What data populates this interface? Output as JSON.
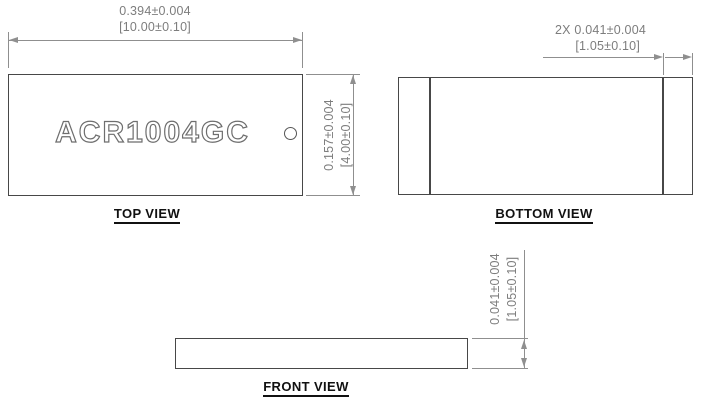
{
  "part_marking": "ACR1004GC",
  "views": {
    "top": {
      "label": "TOP VIEW",
      "dim_width": {
        "line1": "0.394±0.004",
        "line2": "[10.00±0.10]"
      },
      "dim_height": {
        "line1": "0.157±0.004",
        "line2": "[4.00±0.10]"
      }
    },
    "bottom": {
      "label": "BOTTOM VIEW",
      "dim_pad": {
        "line1": "2X 0.041±0.004",
        "line2": "[1.05±0.10]"
      }
    },
    "front": {
      "label": "FRONT VIEW",
      "dim_thickness": {
        "line1": "0.041±0.004",
        "line2": "[1.05±0.10]"
      }
    }
  },
  "colors": {
    "part_outline": "#474747",
    "dimension_lines": "#8f8f8f",
    "dimension_text": "#7d7d7d",
    "label_text": "#111111",
    "background": "#ffffff"
  }
}
